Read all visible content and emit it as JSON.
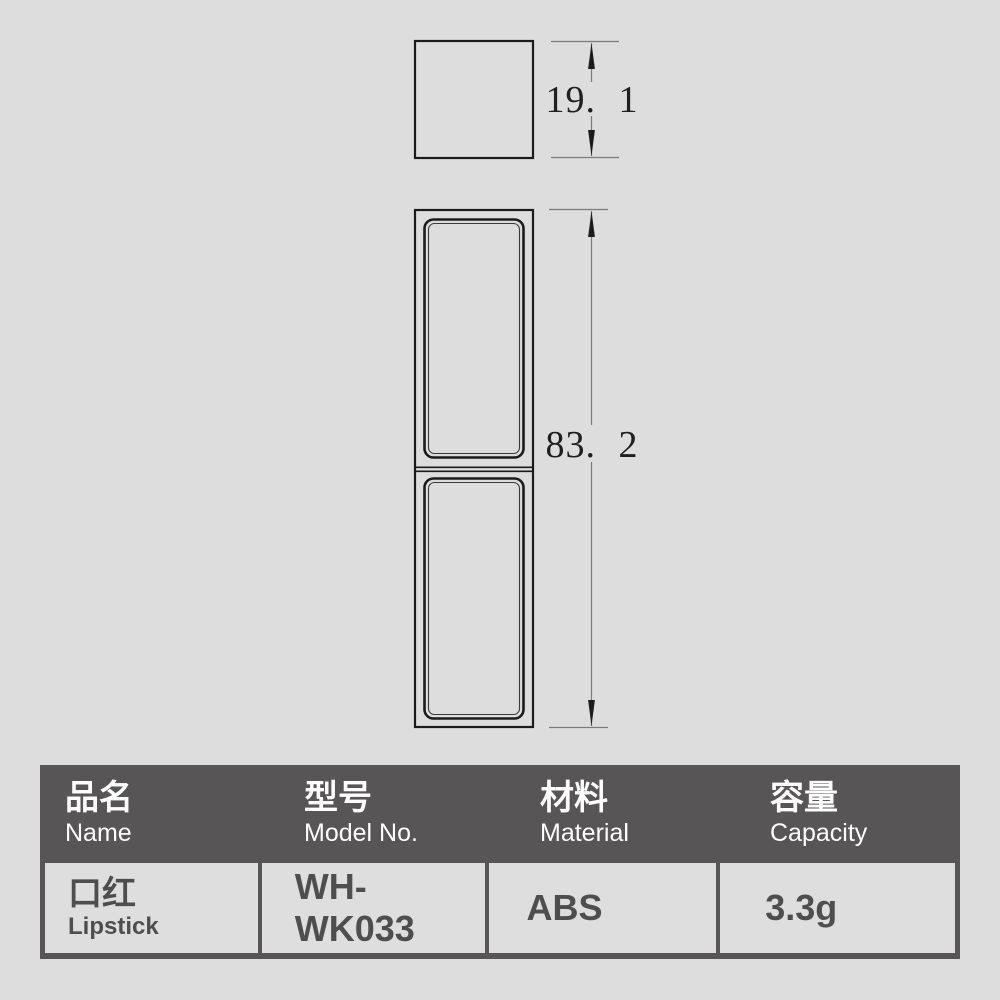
{
  "colors": {
    "page_background": "#dddddd",
    "table_header_background": "#575556",
    "table_cell_background": "#dedede",
    "header_text": "#ffffff",
    "cell_text": "#4f4e4e",
    "drawing_stroke": "#1b1b1b",
    "dimension_line": "#7a7a7a"
  },
  "drawing": {
    "cap_height_dimension": "19. 1",
    "body_height_dimension": "83. 2"
  },
  "table": {
    "columns": [
      {
        "zh": "品名",
        "en": "Name"
      },
      {
        "zh": "型号",
        "en": "Model No."
      },
      {
        "zh": "材料",
        "en": "Material"
      },
      {
        "zh": "容量",
        "en": "Capacity"
      }
    ],
    "row": {
      "name_zh": "口红",
      "name_en": "Lipstick",
      "model_no": "WH-WK033",
      "material": "ABS",
      "capacity": "3.3g"
    }
  }
}
